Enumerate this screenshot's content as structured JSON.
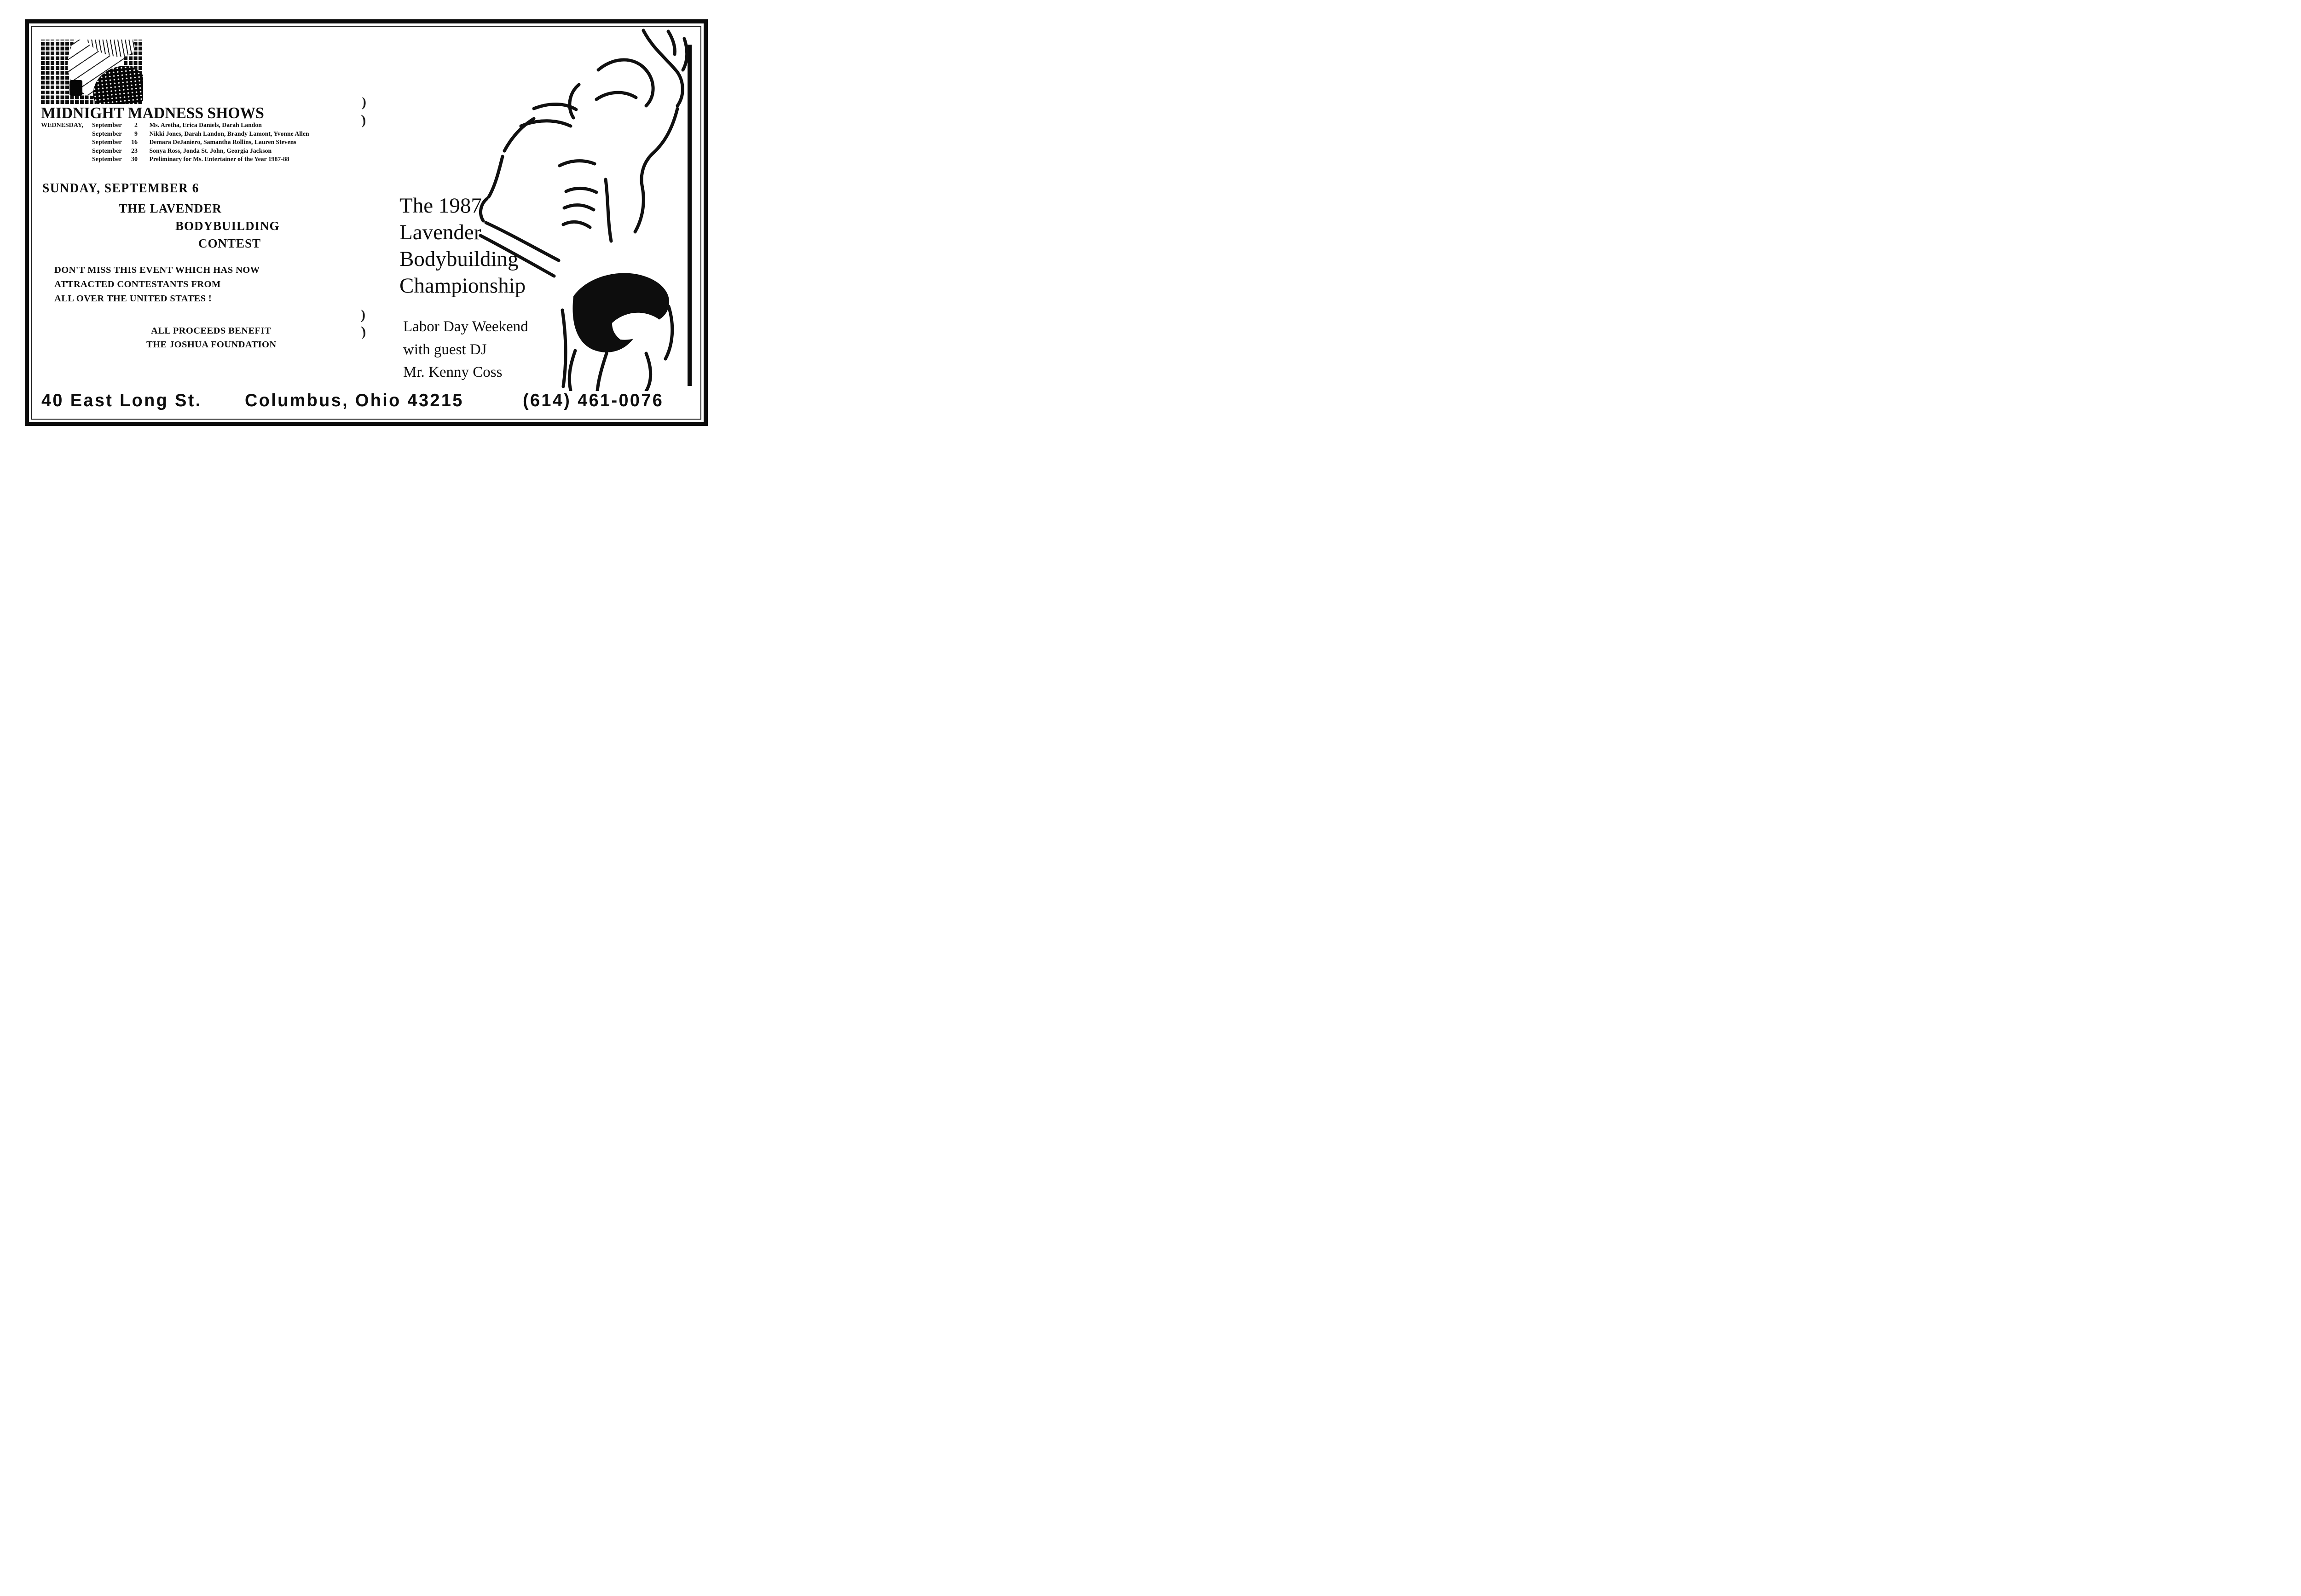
{
  "colors": {
    "ink": "#0d0d0d",
    "paper": "#ffffff"
  },
  "logo": {
    "description": "halftone-grid-photo"
  },
  "shows": {
    "title": "MIDNIGHT MADNESS SHOWS",
    "schedule": [
      {
        "day": "WEDNESDAY,",
        "month": "September",
        "date": "2",
        "lineup": "Ms. Aretha, Erica Daniels, Darah Landon"
      },
      {
        "day": "",
        "month": "September",
        "date": "9",
        "lineup": "Nikki Jones, Darah Landon, Brandy Lamont, Yvonne Allen"
      },
      {
        "day": "",
        "month": "September",
        "date": "16",
        "lineup": "Demara DeJaniero, Samantha Rollins, Lauren Stevens"
      },
      {
        "day": "",
        "month": "September",
        "date": "23",
        "lineup": "Sonya Ross, Jonda St. John, Georgia Jackson"
      },
      {
        "day": "",
        "month": "September",
        "date": "30",
        "lineup": "Preliminary for Ms. Entertainer of the Year 1987-88"
      }
    ]
  },
  "contest": {
    "date_line": "SUNDAY, SEPTEMBER 6",
    "name_line1": "THE LAVENDER",
    "name_line2": "BODYBUILDING",
    "name_line3": "CONTEST",
    "pitch_line1": "DON'T MISS THIS EVENT WHICH HAS NOW",
    "pitch_line2": "ATTRACTED CONTESTANTS FROM",
    "pitch_line3": "ALL OVER THE UNITED STATES !",
    "benefit_line1": "ALL PROCEEDS BENEFIT",
    "benefit_line2": "THE JOSHUA FOUNDATION"
  },
  "championship": {
    "headline_line1": "The 1987",
    "headline_line2": "Lavender",
    "headline_line3": "Bodybuilding",
    "headline_line4": "Championship",
    "sub_line1": "Labor Day Weekend",
    "sub_line2": "with guest DJ",
    "sub_line3": "Mr. Kenny Coss"
  },
  "footer": {
    "street": "40 East Long St.",
    "city_zip": "Columbus, Ohio 43215",
    "phone": "(614) 461-0076"
  },
  "artifacts": {
    "mark": ")"
  }
}
